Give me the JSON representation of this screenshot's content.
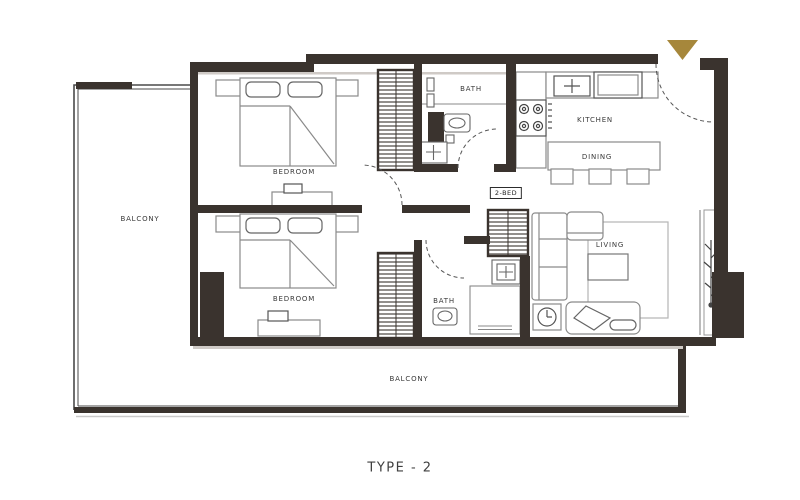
{
  "meta": {
    "caption": "TYPE - 2"
  },
  "plan": {
    "unit_tag": "2-BED",
    "rooms": {
      "bedroom_top": "BEDROOM",
      "bedroom_bottom": "BEDROOM",
      "bath_top": "BATH",
      "bath_bottom": "BATH",
      "kitchen": "KITCHEN",
      "dining": "DINING",
      "living": "LIVING",
      "balcony_left": "BALCONY",
      "balcony_bottom": "BALCONY"
    },
    "icons": {
      "entrance_marker": "triangle-down"
    },
    "colors": {
      "wall": "#3a332e",
      "furniture_line": "#8a8a8a",
      "entrance_marker": "#a6873b",
      "label_text": "#3a3a3a"
    }
  }
}
